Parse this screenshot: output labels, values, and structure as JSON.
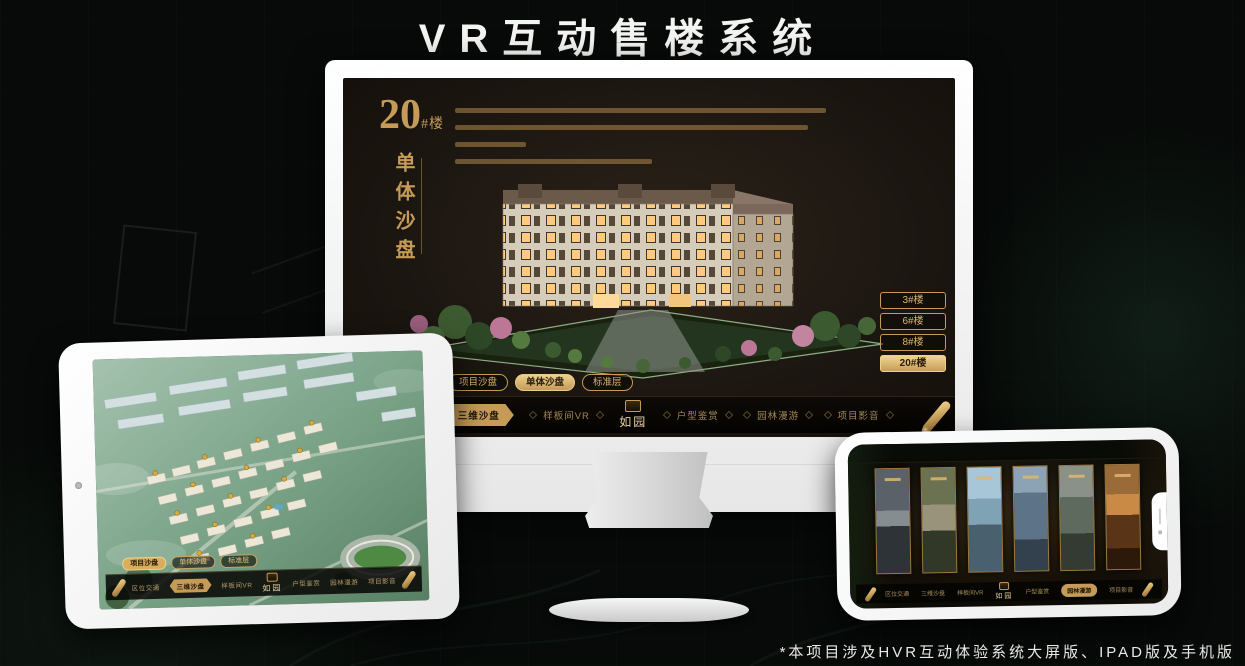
{
  "page": {
    "title": "VR互动售楼系统",
    "footnote": "*本项目涉及HVR互动体验系统大屏版、IPAD版及手机版"
  },
  "colors": {
    "gold": "#c59b57",
    "gold_bright": "#ecd28e",
    "screen_bg": "#1d1712",
    "nav_bg": "#0a0805"
  },
  "monitor_app": {
    "block_number": "20",
    "block_unit": "#楼",
    "block_subtitle": "单体沙盘",
    "desc_line_styles": [
      "width:79%",
      "width:75%",
      "width:15%",
      "width:42%"
    ],
    "floor_buttons": [
      {
        "label": "3#楼",
        "selected": false
      },
      {
        "label": "6#楼",
        "selected": false
      },
      {
        "label": "8#楼",
        "selected": false
      },
      {
        "label": "20#楼",
        "selected": true
      }
    ],
    "tabs": [
      {
        "label": "项目沙盘",
        "selected": false
      },
      {
        "label": "单体沙盘",
        "selected": true
      },
      {
        "label": "标准层",
        "selected": false
      }
    ],
    "nav_items": [
      {
        "label": "区位交通",
        "selected": false
      },
      {
        "label": "三维沙盘",
        "selected": true
      },
      {
        "label": "样板间VR",
        "selected": false
      },
      {
        "label": "户型鉴赏",
        "selected": false
      },
      {
        "label": "园林漫游",
        "selected": false
      },
      {
        "label": "项目影音",
        "selected": false
      }
    ],
    "logo_text": "如园"
  },
  "ipad_app": {
    "tabs": [
      {
        "label": "项目沙盘",
        "selected": true
      },
      {
        "label": "单体沙盘",
        "selected": false
      },
      {
        "label": "标准层",
        "selected": false
      }
    ],
    "nav_items": [
      {
        "label": "区位交通",
        "selected": false
      },
      {
        "label": "三维沙盘",
        "selected": true
      },
      {
        "label": "样板间VR",
        "selected": false
      },
      {
        "label": "户型鉴赏",
        "selected": false
      },
      {
        "label": "园林漫游",
        "selected": false
      },
      {
        "label": "项目影音",
        "selected": false
      }
    ],
    "logo_text": "如园"
  },
  "phone_app": {
    "nav_items": [
      {
        "label": "区位交通",
        "selected": false
      },
      {
        "label": "三维沙盘",
        "selected": false
      },
      {
        "label": "样板间VR",
        "selected": false
      },
      {
        "label": "户型鉴赏",
        "selected": false
      },
      {
        "label": "园林漫游",
        "selected": true
      },
      {
        "label": "项目影音",
        "selected": false
      }
    ],
    "logo_text": "如园"
  }
}
